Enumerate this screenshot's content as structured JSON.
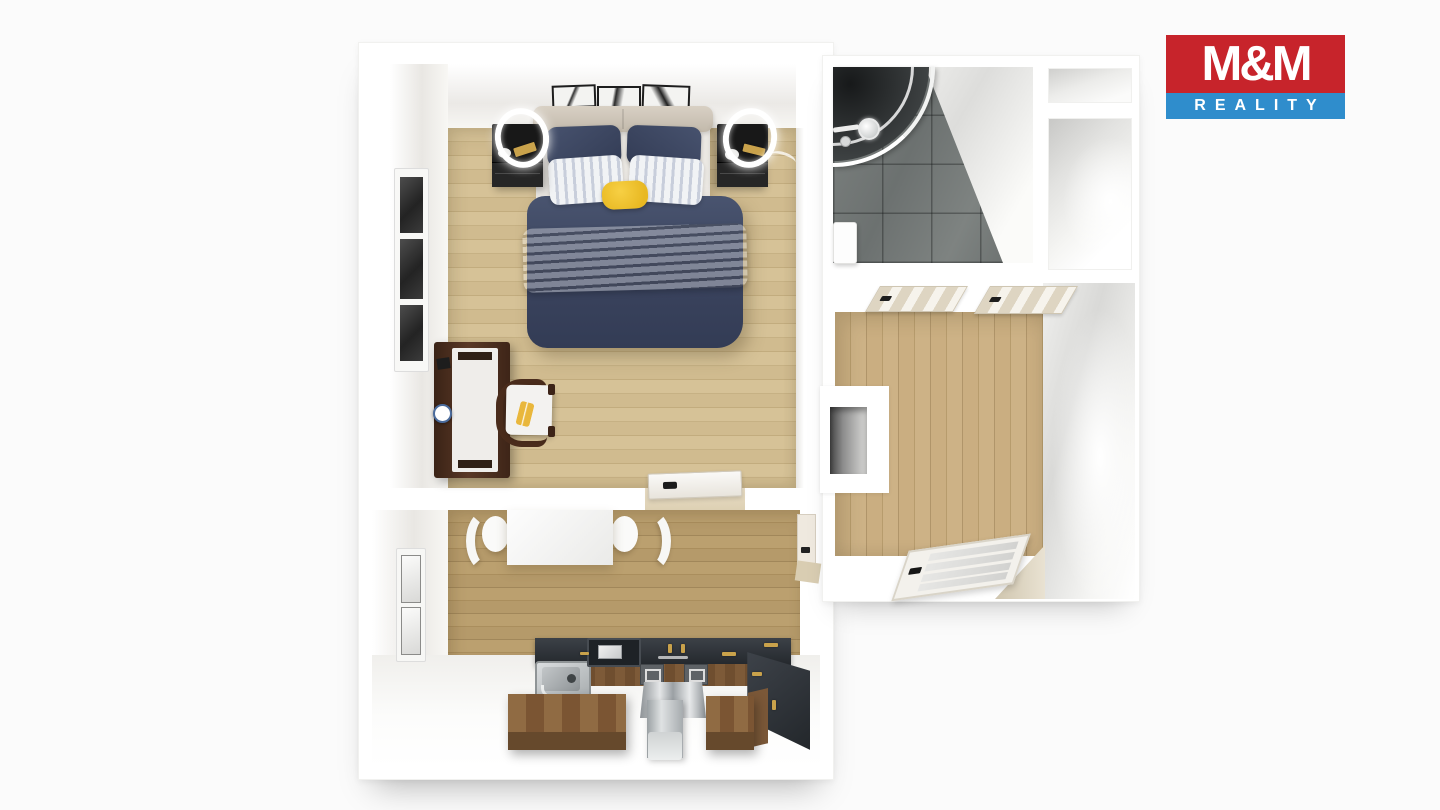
{
  "scene": {
    "description": "3D top-down floor plan render of a one-bedroom apartment",
    "background_color": "#fbfbfb"
  },
  "logo": {
    "brand_top": "M&M",
    "brand_bottom": "REALITY",
    "top_bg": "#c7242b",
    "bottom_bg": "#2f8dcc",
    "text_color": "#ffffff"
  },
  "palette": {
    "wall_white": "#ffffff",
    "bedroom_floor": "#d0bb8f",
    "kitchen_floor": "#b59a6e",
    "hallway_floor": "#c3a87a",
    "bathroom_tile": "#737876",
    "duvet_navy": "#3d4763",
    "pillow_navy": "#3c4660",
    "blanket_beige": "#c7c0b6",
    "accent_yellow": "#eec02f",
    "nightstand_black": "#1a1a1a",
    "desk_brown": "#4a3024",
    "counter_dark": "#2e3338",
    "cabinet_wood": "#7d5a38",
    "stainless": "#c3c7c9",
    "brass": "#c9a24b"
  },
  "rooms": [
    {
      "id": "bedroom",
      "furniture": [
        "double-bed",
        "nightstand-left",
        "nightstand-right",
        "ring-lamp-left",
        "ring-lamp-right",
        "wall-art-frames",
        "desk",
        "chair",
        "window",
        "door"
      ]
    },
    {
      "id": "kitchen",
      "furniture": [
        "dining-table",
        "chair-left",
        "chair-right",
        "kitchen-counter",
        "sink",
        "cooktop",
        "fridge",
        "island-cabinets",
        "window",
        "door"
      ]
    },
    {
      "id": "bathroom",
      "furniture": [
        "corner-shower",
        "bath-mat"
      ]
    },
    {
      "id": "hallway",
      "furniture": [
        "door-to-bathroom",
        "door-to-room",
        "glass-entry-door",
        "wall-niche"
      ]
    },
    {
      "id": "utility-closets",
      "furniture": []
    }
  ]
}
